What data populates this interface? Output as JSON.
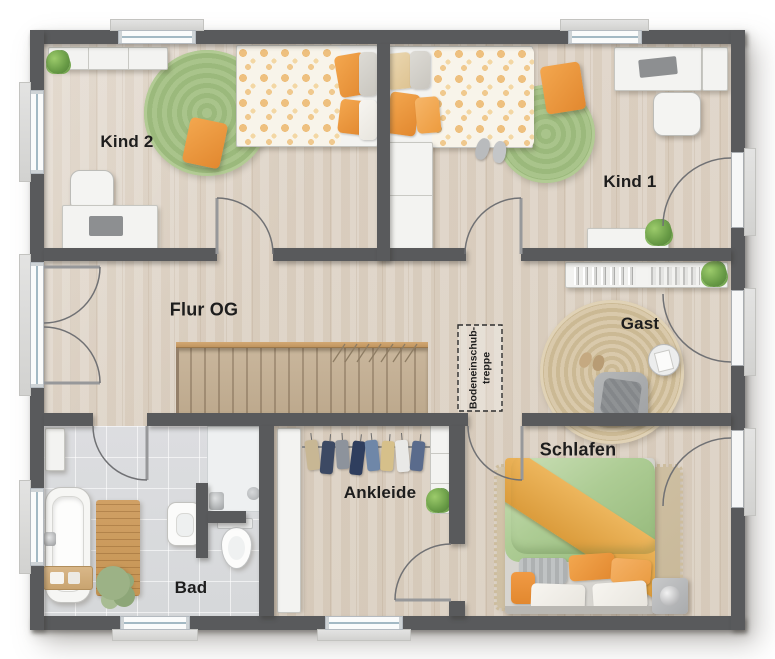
{
  "rooms": {
    "kind2": {
      "label": "Kind 2"
    },
    "kind1": {
      "label": "Kind 1"
    },
    "flur": {
      "label": "Flur OG"
    },
    "gast": {
      "label": "Gast"
    },
    "schlafen": {
      "label": "Schlafen"
    },
    "ankleide": {
      "label": "Ankleide"
    },
    "bad": {
      "label": "Bad"
    }
  },
  "stair_note": {
    "line1": "Bodeneinschub-",
    "line2": "treppe"
  },
  "colors": {
    "wall": "#595a5c",
    "wood_floor": "#ddd2c5",
    "tile_floor": "#dcdde0",
    "rug_green": "#a5c287",
    "rug_jute": "#d6c5a6",
    "accent_orange": "#ef9840",
    "duvet_green": "#b4cf9f"
  }
}
